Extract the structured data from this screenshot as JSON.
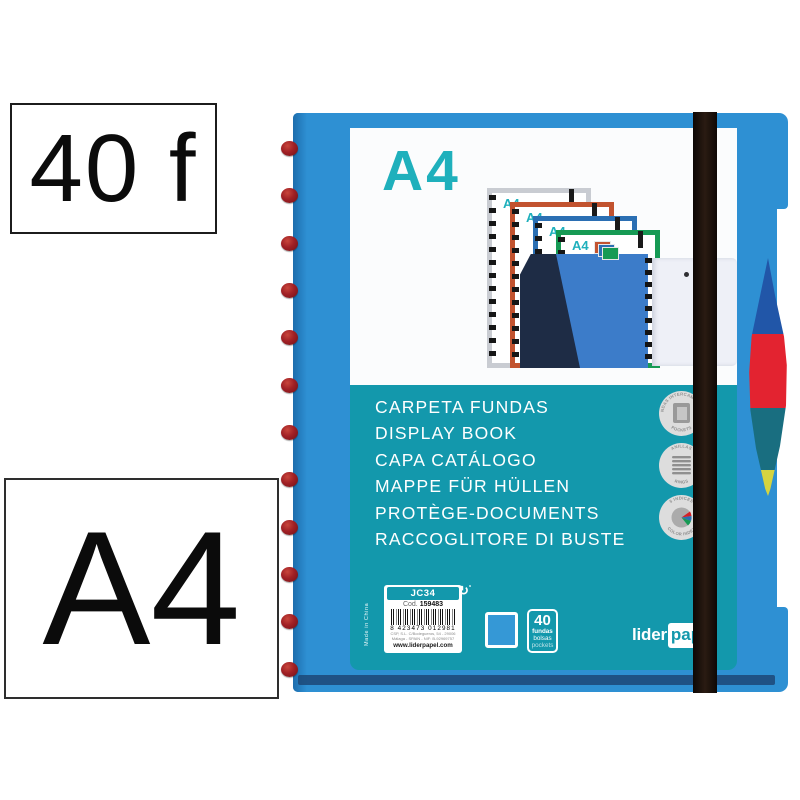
{
  "annotations": {
    "sheet_count_label": "40 f",
    "format_label": "A4"
  },
  "product": {
    "format_heading": "A4",
    "cascade_format": "A4",
    "title_lines": [
      "CARPETA FUNDAS",
      "DISPLAY BOOK",
      "CAPA CATÁLOGO",
      "MAPPE FÜR HÜLLEN",
      "PROTÈGE-DOCUMENTS",
      "RACCOGLITORE DI BUSTE"
    ],
    "badges": [
      {
        "top_text": "FUNDAS INTERCAMBIABLES",
        "bottom_text": "POCKETS"
      },
      {
        "top_text": "ANILLAS",
        "bottom_text": "RINGS"
      },
      {
        "top_text": "5 INDICES",
        "bottom_text": "COLOR INDEX"
      }
    ],
    "info_label": {
      "model": "JC34",
      "code_prefix": "Cod.",
      "code": "159483",
      "ean": "8 423473 012981",
      "address_line_1": "CSP, S.L. C/Bodegueros, 54 - 29006",
      "address_line_2": "Málaga - SPAIN - NIF: B-92969757",
      "website": "www.liderpapel.com"
    },
    "made_in": "Made in China",
    "capacity": {
      "number": "40",
      "unit_lines": [
        "fundas",
        "bolsas",
        "pockets"
      ]
    },
    "brand": {
      "first": "lider",
      "second": "papel"
    },
    "colors": {
      "cover_blue": "#2E90D3",
      "panel_teal": "#1398AC",
      "heading_teal": "#1FB0BC",
      "tab_blue": "#2156A8",
      "tab_red": "#E32330",
      "tab_teal": "#196E80",
      "tab_yellow": "#D5D440",
      "elastic_black": "#1A100B",
      "spiral_dot_red": "#9E1B22",
      "swatch_blue": "#3598D6"
    }
  }
}
